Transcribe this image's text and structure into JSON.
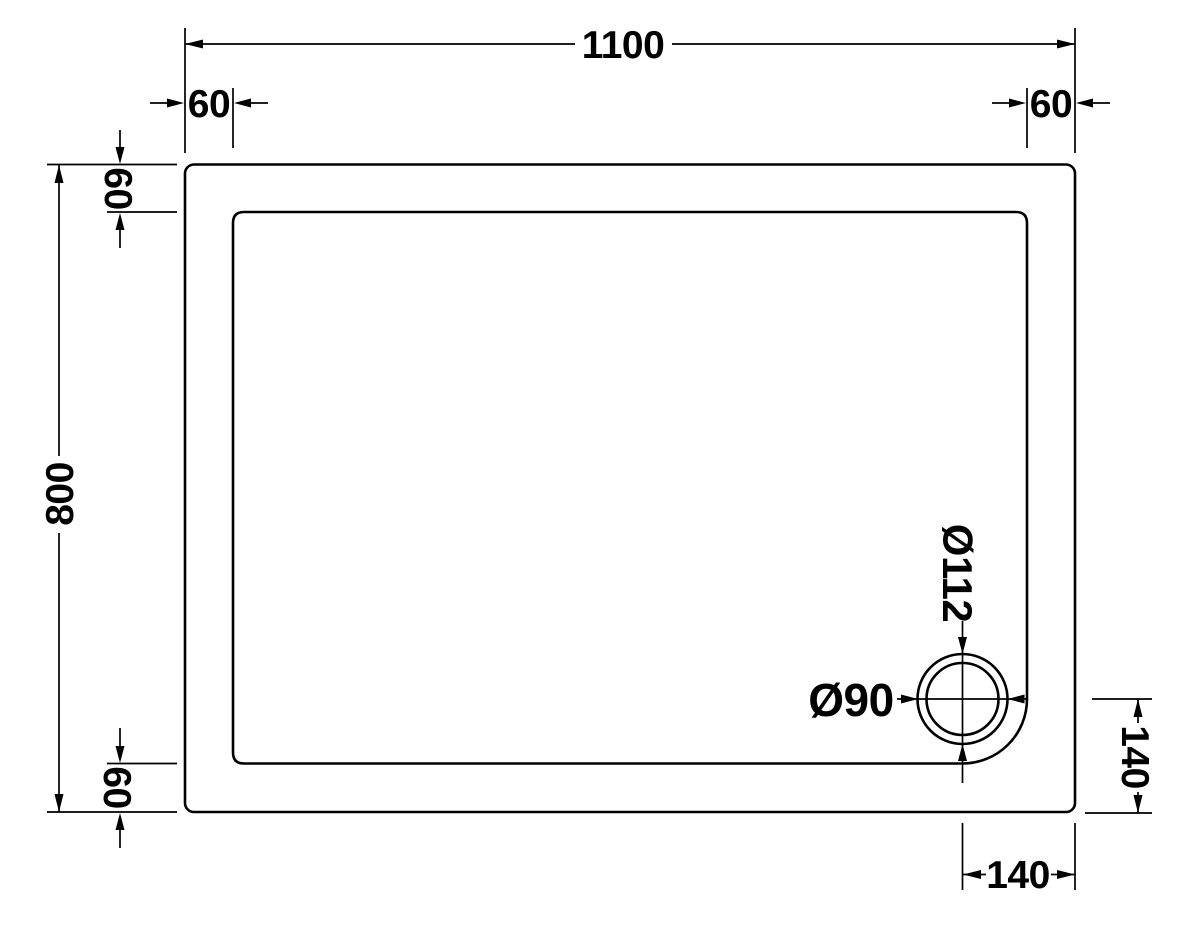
{
  "diagram": {
    "subject": "Rectangular shower tray - top view technical drawing with offset waste",
    "background_color": "#ffffff",
    "line_color": "#000000",
    "dimensions": {
      "overall_width": "1100",
      "overall_height": "800",
      "flange_top_left": "60",
      "flange_top_right": "60",
      "flange_left_top": "60",
      "flange_left_bottom": "60",
      "waste_outer_diameter": "Ø112",
      "waste_inner_diameter": "Ø90",
      "waste_offset_from_right": "140",
      "waste_offset_from_bottom": "140"
    }
  }
}
